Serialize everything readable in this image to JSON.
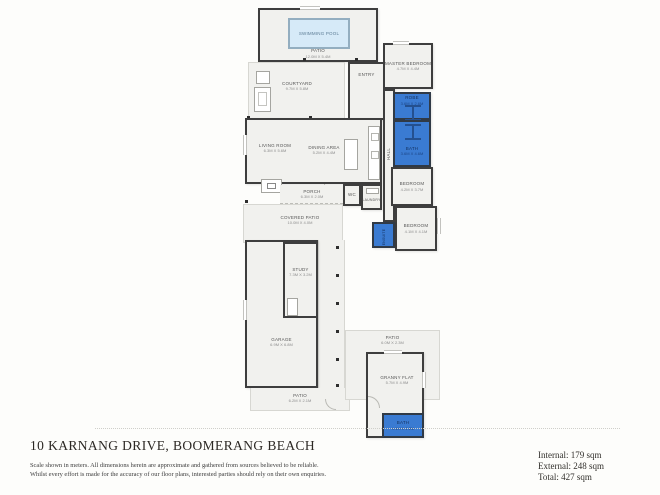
{
  "page": {
    "title": "10 KARNANG DRIVE, BOOMERANG BEACH",
    "disclaimer_line1": "Scale shown in meters. All dimensions herein are approximate and gathered from sources believed to be  reliable.",
    "disclaimer_line2": "Whilst every effort is made for the accuracy of our floor plans, interested parties should rely on their own enquiries.",
    "areas": {
      "internal": "Internal: 179 sqm",
      "external": "External: 248 sqm",
      "total": "Total: 427 sqm"
    }
  },
  "colors": {
    "wall": "#3e3e3e",
    "floor": "#f1f1ee",
    "wet_area_blue": "#3a7bd2",
    "pool_water": "#d6eaf8"
  },
  "rooms": {
    "swimming_pool": {
      "name": "SWIMMING POOL"
    },
    "pool_patio": {
      "name": "PATIO",
      "dims": "12.0M X 5.4M"
    },
    "courtyard": {
      "name": "COURTYARD",
      "dims": "9.7M X 5.8M"
    },
    "entry": {
      "name": "ENTRY"
    },
    "living_room": {
      "name": "LIVING ROOM",
      "dims": "6.3M X 5.6M"
    },
    "dining_area": {
      "name": "DINING AREA",
      "dims": "5.2M X 4.4M"
    },
    "porch": {
      "name": "PORCH",
      "dims": "6.3M X 2.0M"
    },
    "covered_patio": {
      "name": "COVERED PATIO",
      "dims": "10.0M X 4.0M"
    },
    "wc": {
      "name": "WC"
    },
    "laundry": {
      "name": "LAUNDRY"
    },
    "master_bedroom": {
      "name": "MASTER BEDROOM",
      "dims": "4.7M X 4.4M"
    },
    "robe": {
      "name": "ROBE",
      "dims": "3.6M X 2.6M"
    },
    "bath": {
      "name": "BATH",
      "dims": "3.6M X 4.6M"
    },
    "hall": {
      "name": "HALL"
    },
    "bedroom1": {
      "name": "BEDROOM",
      "dims": "4.2M X 3.7M"
    },
    "bedroom2": {
      "name": "BEDROOM",
      "dims": "4.1M X 4.1M"
    },
    "ensuite": {
      "name": "ENSUITE"
    },
    "study": {
      "name": "STUDY",
      "dims": "7.3M X 3.2M"
    },
    "garage": {
      "name": "GARAGE",
      "dims": "6.9M X 6.8M"
    },
    "rear_patio": {
      "name": "PATIO",
      "dims": "6.2M X 2.1M"
    },
    "gf_patio": {
      "name": "PATIO",
      "dims": "6.0M X 2.3M"
    },
    "granny_flat": {
      "name": "GRANNY FLAT",
      "dims": "5.7M X 4.9M"
    },
    "gf_bath": {
      "name": "BATH",
      "dims": "4.1M X 2.2M"
    }
  }
}
